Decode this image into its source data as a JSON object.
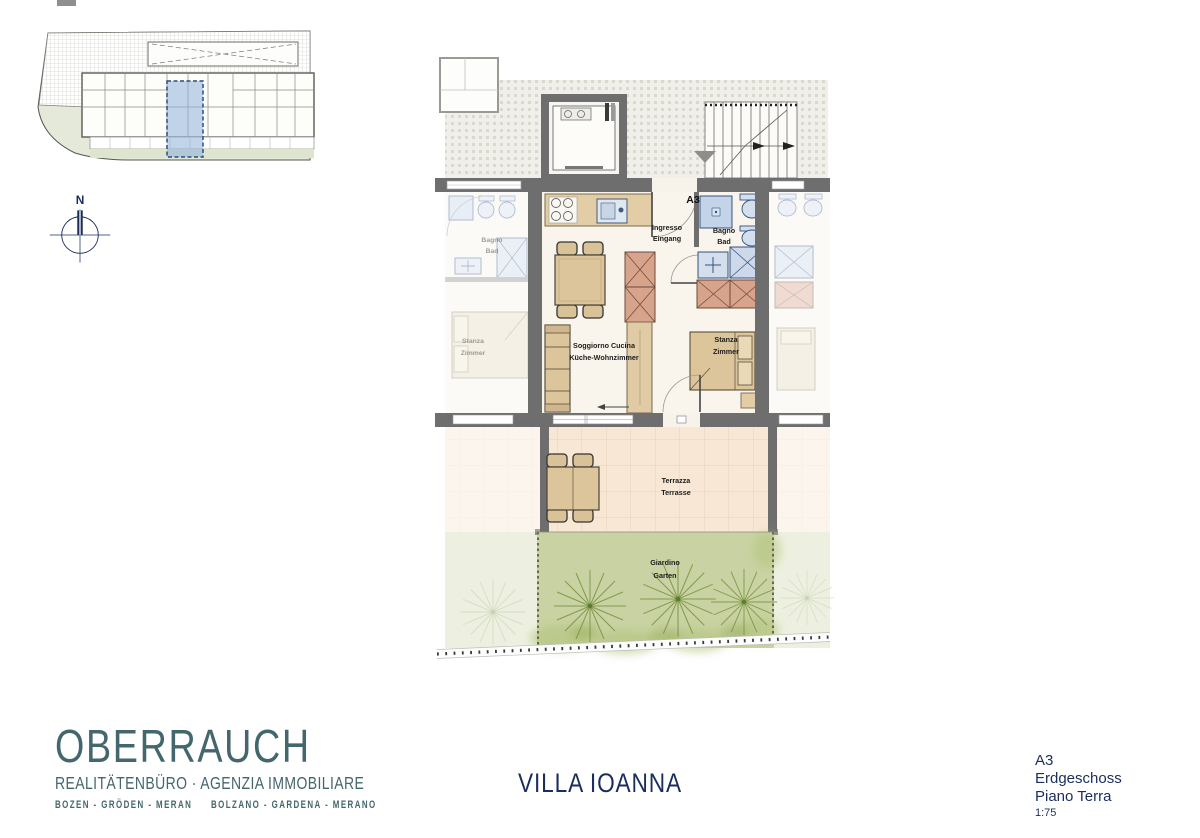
{
  "north_arrow": {
    "label": "N"
  },
  "floor_plan": {
    "unit_label": "A3",
    "labels": {
      "entrance_it": "Ingresso",
      "entrance_de": "Eingang",
      "living_it": "Soggiorno Cucina",
      "living_de": "Küche-Wohnzimmer",
      "bedroom_it": "Stanza",
      "bedroom_de": "Zimmer",
      "bath_it": "Bagno",
      "bath_de": "Bad",
      "terrace_it": "Terrazza",
      "terrace_de": "Terrasse",
      "garden_it": "Giardino",
      "garden_de": "Garten"
    },
    "neighbor_labels": {
      "bath_it": "Bagno",
      "bath_de": "Bad",
      "bedroom_it": "Stanza",
      "bedroom_de": "Zimmer"
    }
  },
  "theme": {
    "brand_teal": "#44666d",
    "navy": "#1b2d5e",
    "wall_grey": "#6e6e6e",
    "floor_cream": "#f9f5ec",
    "furniture_tan": "#dcc49b",
    "fixture_blue": "#c3d4e9",
    "cabinet_red": "#d8a38b",
    "terrace_peach": "#f8e7d4",
    "garden_green": "#c9d2a2",
    "site_green": "#e4e9da",
    "highlight_blue": "#8fb0d9"
  },
  "footer": {
    "brand": {
      "name": "OBERRAUCH",
      "tagline": "REALITÄTENBÜRO · AGENZIA IMMOBILIARE",
      "cities_de": "BOZEN - GRÖDEN - MERAN",
      "cities_it": "BOLZANO - GARDENA - MERANO"
    },
    "project": {
      "title": "VILLA IOANNA"
    },
    "sheet": {
      "unit": "A3",
      "floor_de": "Erdgeschoss",
      "floor_it": "Piano Terra",
      "scale": "1:75"
    }
  }
}
